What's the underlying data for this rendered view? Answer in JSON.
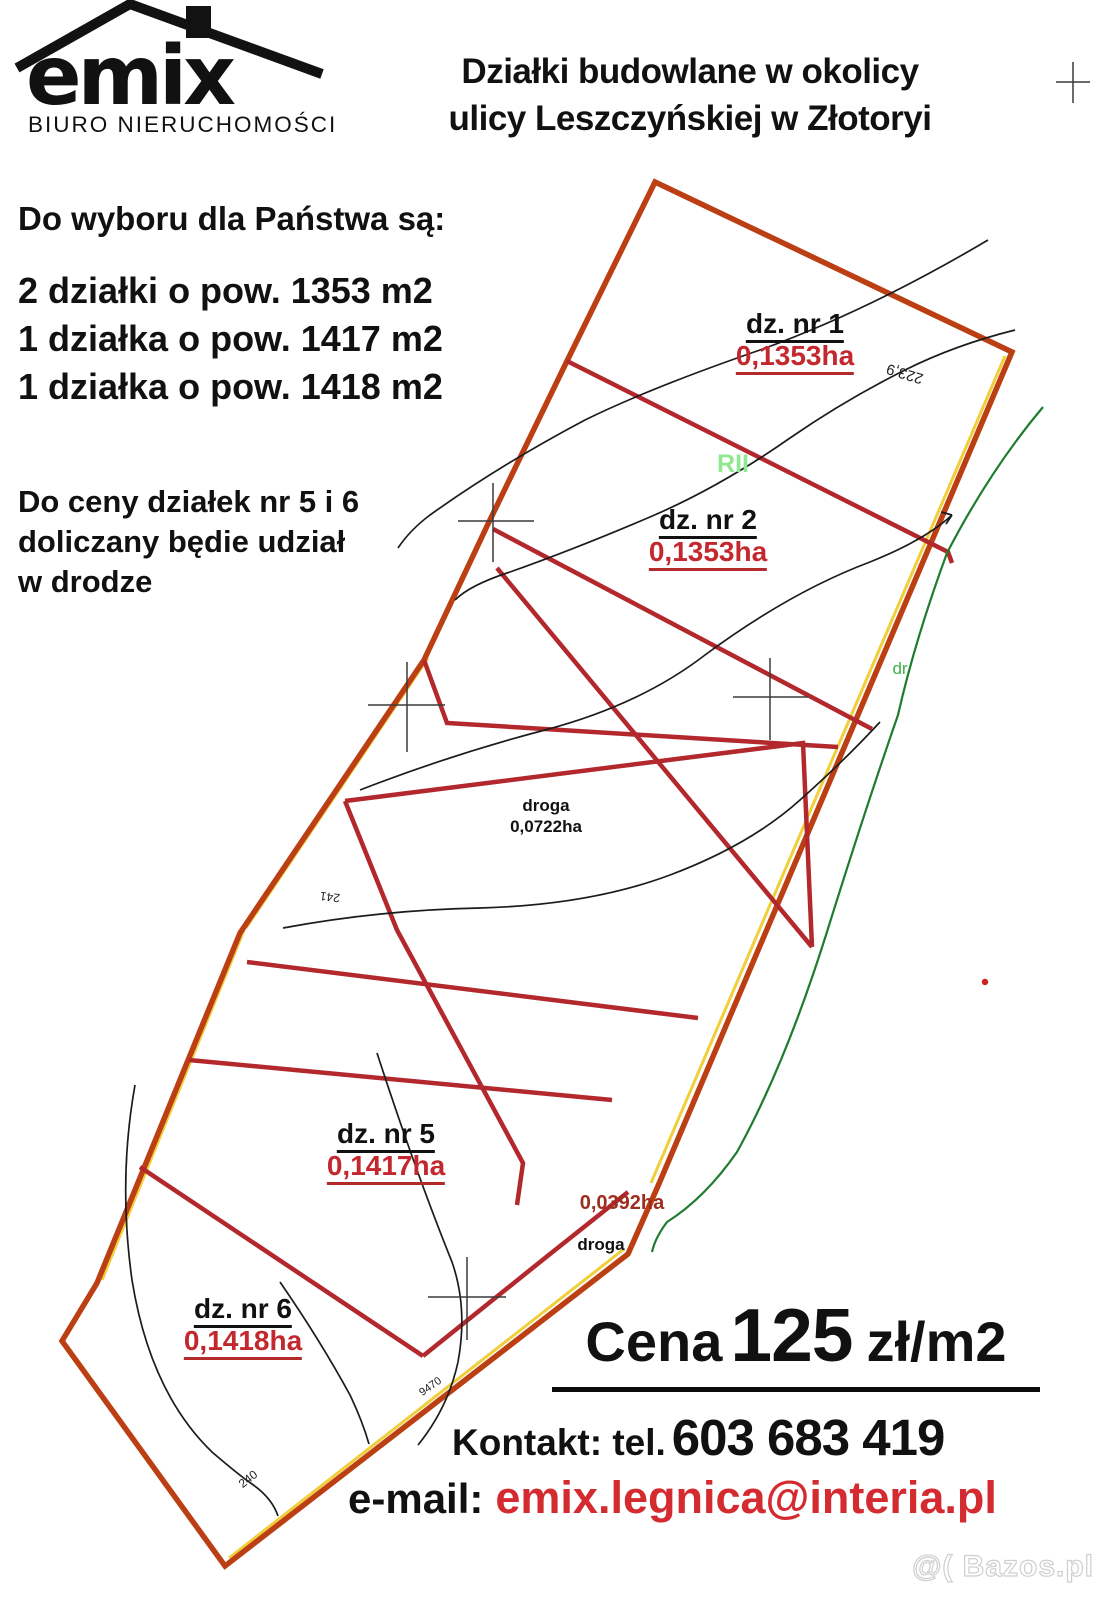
{
  "logo": {
    "name": "emix",
    "subtitle": "BIURO NIERUCHOMOŚCI"
  },
  "header": {
    "title_line1": "Działki budowlane w okolicy",
    "title_line2": "ulicy Leszczyńskiej w Złotoryi"
  },
  "offer": {
    "intro": "Do wyboru  dla Państwa są:",
    "items": [
      "2 działki o pow. 1353 m2",
      "1 działka o pow. 1417 m2",
      "1 działka o pow. 1418 m2"
    ],
    "note_line1": "Do ceny działek nr 5 i 6",
    "note_line2": "doliczany będie udział",
    "note_line3": "w drodze"
  },
  "map": {
    "parcels": [
      {
        "id": "dz. nr 1",
        "area": "0,1353ha"
      },
      {
        "id": "dz. nr 2",
        "area": "0,1353ha"
      },
      {
        "id": "dz. nr 5",
        "area": "0,1417ha"
      },
      {
        "id": "dz. nr 6",
        "area": "0,1418ha"
      }
    ],
    "road_main": {
      "label": "droga",
      "area": "0,0722ha"
    },
    "road_small": {
      "label": "droga",
      "area": "0,0392ha"
    },
    "annotations": {
      "land_class": "RII",
      "green_road": "dr",
      "elevation1": "223,9",
      "elevation2": "241",
      "elevation3": "240",
      "elevation4": "9470"
    },
    "colors": {
      "boundary": "#bc3f14",
      "division": "#b3282c",
      "yellow_edge": "#f0cf3a",
      "green_line": "#1f7c2e",
      "green_text": "#3fae4a",
      "class_text": "#8fe98f",
      "area_text": "#c2282d"
    }
  },
  "pricing": {
    "price_prefix": "Cena",
    "price_value": "125",
    "price_unit": "zł/m2",
    "contact_prefix": "Kontakt: tel.",
    "phone": "603 683 419",
    "email_prefix": "e-mail:",
    "email": "emix.legnica@interia.pl"
  },
  "watermark": "@( Bazos.pl"
}
